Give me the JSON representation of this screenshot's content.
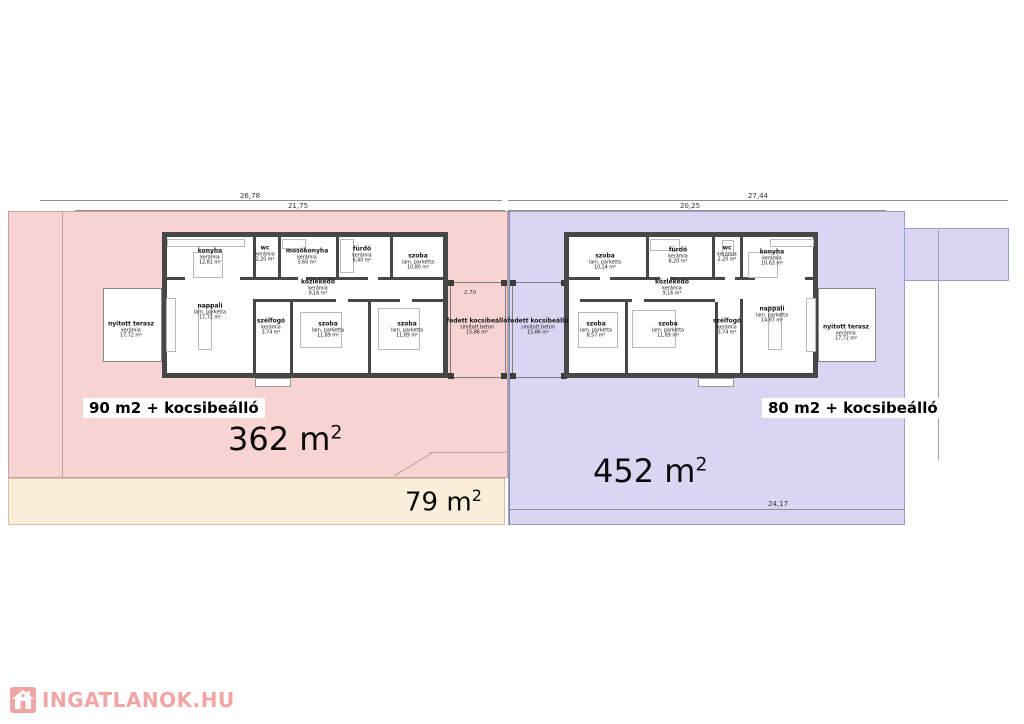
{
  "watermark": {
    "text": "INGATLANOK.HU",
    "color": "#f2a5a5"
  },
  "plots": {
    "left": {
      "highlight_label": "90 m2 + kocsibeálló",
      "area_num": "362",
      "area_unit": " m",
      "area_exp": "2",
      "fill": "#f8d3d3"
    },
    "right": {
      "highlight_label": "80 m2 + kocsibeálló",
      "area_num": "452",
      "area_unit": " m",
      "area_exp": "2",
      "fill": "#d9d6f1"
    },
    "strip": {
      "area_num": "79",
      "area_unit": " m",
      "area_exp": "2",
      "fill": "#fbeeda"
    }
  },
  "dims": {
    "top_left_outer": "26,78",
    "top_left_inner": "21,75",
    "top_right_outer": "27,44",
    "top_right_inner": "20,25",
    "bottom_right": "24,17",
    "small": [
      "4,20",
      "7,20",
      "2,70",
      "1,90",
      "2,35",
      "3,50",
      "4,10",
      "5,70"
    ]
  },
  "houses": {
    "left": {
      "rooms": [
        {
          "name": "konyha",
          "material": "kerámia",
          "area": "12,81 m²"
        },
        {
          "name": "wc",
          "material": "kerámia",
          "area": "2,20 m²"
        },
        {
          "name": "mosókonyha",
          "material": "kerámia",
          "area": "5,60 m²"
        },
        {
          "name": "fürdő",
          "material": "kerámia",
          "area": "6,40 m²"
        },
        {
          "name": "szoba",
          "material": "lam. parketta",
          "area": "10,80 m²"
        },
        {
          "name": "közlekedő",
          "material": "kerámia",
          "area": "9,16 m²"
        },
        {
          "name": "nappali",
          "material": "lam. parketta",
          "area": "17,72 m²"
        },
        {
          "name": "szélfogó",
          "material": "kerámia",
          "area": "3,74 m²"
        },
        {
          "name": "szoba",
          "material": "lam. parketta",
          "area": "11,89 m²"
        },
        {
          "name": "szoba",
          "material": "lam. parketta",
          "area": "11,89 m²"
        },
        {
          "name": "nyitott terasz",
          "material": "kerámia",
          "area": "17,72 m²"
        },
        {
          "name": "fedett kocsibeálló",
          "material": "simított beton",
          "area": "15,86 m²"
        }
      ]
    },
    "right": {
      "rooms": [
        {
          "name": "szoba",
          "material": "lam. parketta",
          "area": "10,24 m²"
        },
        {
          "name": "fürdő",
          "material": "kerámia",
          "area": "8,20 m²"
        },
        {
          "name": "wc",
          "material": "kerámia",
          "area": "2,20 m²"
        },
        {
          "name": "konyha",
          "material": "kerámia",
          "area": "10,63 m²"
        },
        {
          "name": "közlekedő",
          "material": "kerámia",
          "area": "9,16 m²"
        },
        {
          "name": "szoba",
          "material": "lam. parketta",
          "area": "8,57 m²"
        },
        {
          "name": "szoba",
          "material": "lam. parketta",
          "area": "11,89 m²"
        },
        {
          "name": "szélfogó",
          "material": "kerámia",
          "area": "3,74 m²"
        },
        {
          "name": "nappali",
          "material": "lam. parketta",
          "area": "14,87 m²"
        },
        {
          "name": "nyitott terasz",
          "material": "kerámia",
          "area": "17,72 m²"
        },
        {
          "name": "fedett kocsibeálló",
          "material": "simított beton",
          "area": "15,86 m²"
        }
      ]
    }
  }
}
